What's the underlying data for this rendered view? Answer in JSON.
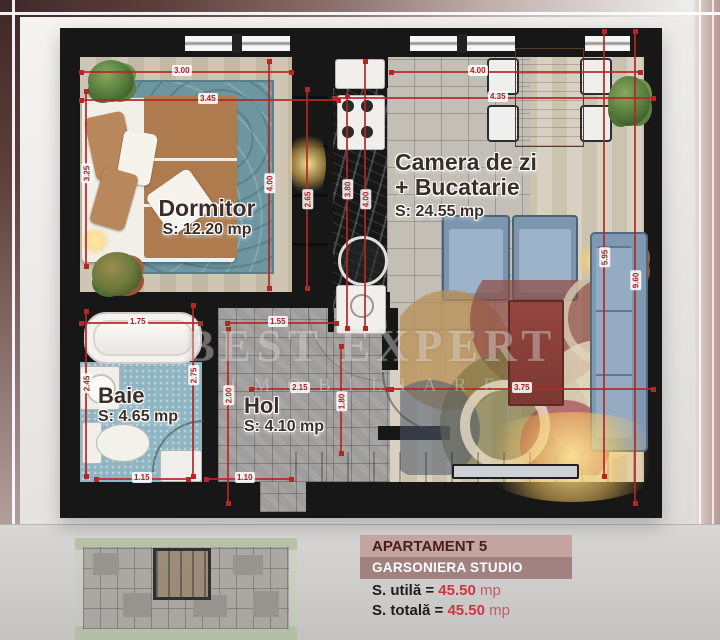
{
  "watermark": {
    "line1": "BEST EXPERT",
    "line2": "IMOBILIARE"
  },
  "rooms": {
    "dormitor": {
      "name": "Dormitor",
      "area": "S: 12.20 mp"
    },
    "living": {
      "name1": "Camera de zi",
      "name2": "+ Bucatarie",
      "area": "S: 24.55 mp"
    },
    "baie": {
      "name": "Baie",
      "area": "S: 4.65 mp"
    },
    "hol": {
      "name": "Hol",
      "area": "S: 4.10 mp"
    }
  },
  "info_panel": {
    "title": "APARTAMENT 5",
    "subtitle": "GARSONIERA STUDIO",
    "rows": [
      {
        "label": "S. utilă =",
        "value": "45.50",
        "unit": "mp"
      },
      {
        "label": "S. totală =",
        "value": "45.50",
        "unit": "mp"
      }
    ]
  },
  "colors": {
    "dimension_red": "#b22826",
    "wall_black": "#171717",
    "accent_maroon": "#47201e",
    "value_red": "#cf3540"
  },
  "plan_dimensions": [
    {
      "label": "3.00",
      "orient": "h",
      "x": 20,
      "y": 43,
      "len": 213,
      "lx": 112,
      "ly": 37
    },
    {
      "label": "3.45",
      "orient": "h",
      "x": 20,
      "y": 71,
      "len": 260,
      "lx": 138,
      "ly": 65
    },
    {
      "label": "4.00",
      "orient": "h",
      "x": 330,
      "y": 43,
      "len": 252,
      "lx": 408,
      "ly": 37
    },
    {
      "label": "4.35",
      "orient": "h",
      "x": 273,
      "y": 69,
      "len": 322,
      "lx": 428,
      "ly": 63
    },
    {
      "label": "1.75",
      "orient": "h",
      "x": 20,
      "y": 294,
      "len": 122,
      "lx": 68,
      "ly": 288
    },
    {
      "label": "1.55",
      "orient": "h",
      "x": 166,
      "y": 294,
      "len": 112,
      "lx": 208,
      "ly": 288
    },
    {
      "label": "2.15",
      "orient": "h",
      "x": 190,
      "y": 360,
      "len": 140,
      "lx": 230,
      "ly": 354
    },
    {
      "label": "3.75",
      "orient": "h",
      "x": 330,
      "y": 360,
      "len": 265,
      "lx": 452,
      "ly": 354
    },
    {
      "label": "1.15",
      "orient": "h",
      "x": 35,
      "y": 450,
      "len": 95,
      "lx": 72,
      "ly": 444
    },
    {
      "label": "1.10",
      "orient": "h",
      "x": 145,
      "y": 450,
      "len": 88,
      "lx": 175,
      "ly": 444
    },
    {
      "label": "3.25",
      "orient": "v",
      "x": 25,
      "y": 62,
      "len": 178,
      "lx": 17,
      "ly": 140
    },
    {
      "label": "4.00",
      "orient": "v",
      "x": 208,
      "y": 32,
      "len": 230,
      "lx": 200,
      "ly": 150
    },
    {
      "label": "2.65",
      "orient": "v",
      "x": 246,
      "y": 60,
      "len": 202,
      "lx": 238,
      "ly": 166
    },
    {
      "label": "3.80",
      "orient": "v",
      "x": 286,
      "y": 67,
      "len": 235,
      "lx": 278,
      "ly": 156
    },
    {
      "label": "4.00",
      "orient": "v",
      "x": 304,
      "y": 32,
      "len": 270,
      "lx": 296,
      "ly": 166
    },
    {
      "label": "2.45",
      "orient": "v",
      "x": 25,
      "y": 282,
      "len": 168,
      "lx": 17,
      "ly": 350
    },
    {
      "label": "2.75",
      "orient": "v",
      "x": 132,
      "y": 276,
      "len": 174,
      "lx": 124,
      "ly": 342
    },
    {
      "label": "2.00",
      "orient": "v",
      "x": 167,
      "y": 300,
      "len": 177,
      "lx": 159,
      "ly": 362
    },
    {
      "label": "1.80",
      "orient": "v",
      "x": 280,
      "y": 317,
      "len": 110,
      "lx": 272,
      "ly": 368
    },
    {
      "label": "5.95",
      "orient": "v",
      "x": 543,
      "y": 2,
      "len": 448,
      "lx": 535,
      "ly": 224
    },
    {
      "label": "9.60",
      "orient": "v",
      "x": 574,
      "y": 2,
      "len": 475,
      "lx": 566,
      "ly": 247
    }
  ]
}
